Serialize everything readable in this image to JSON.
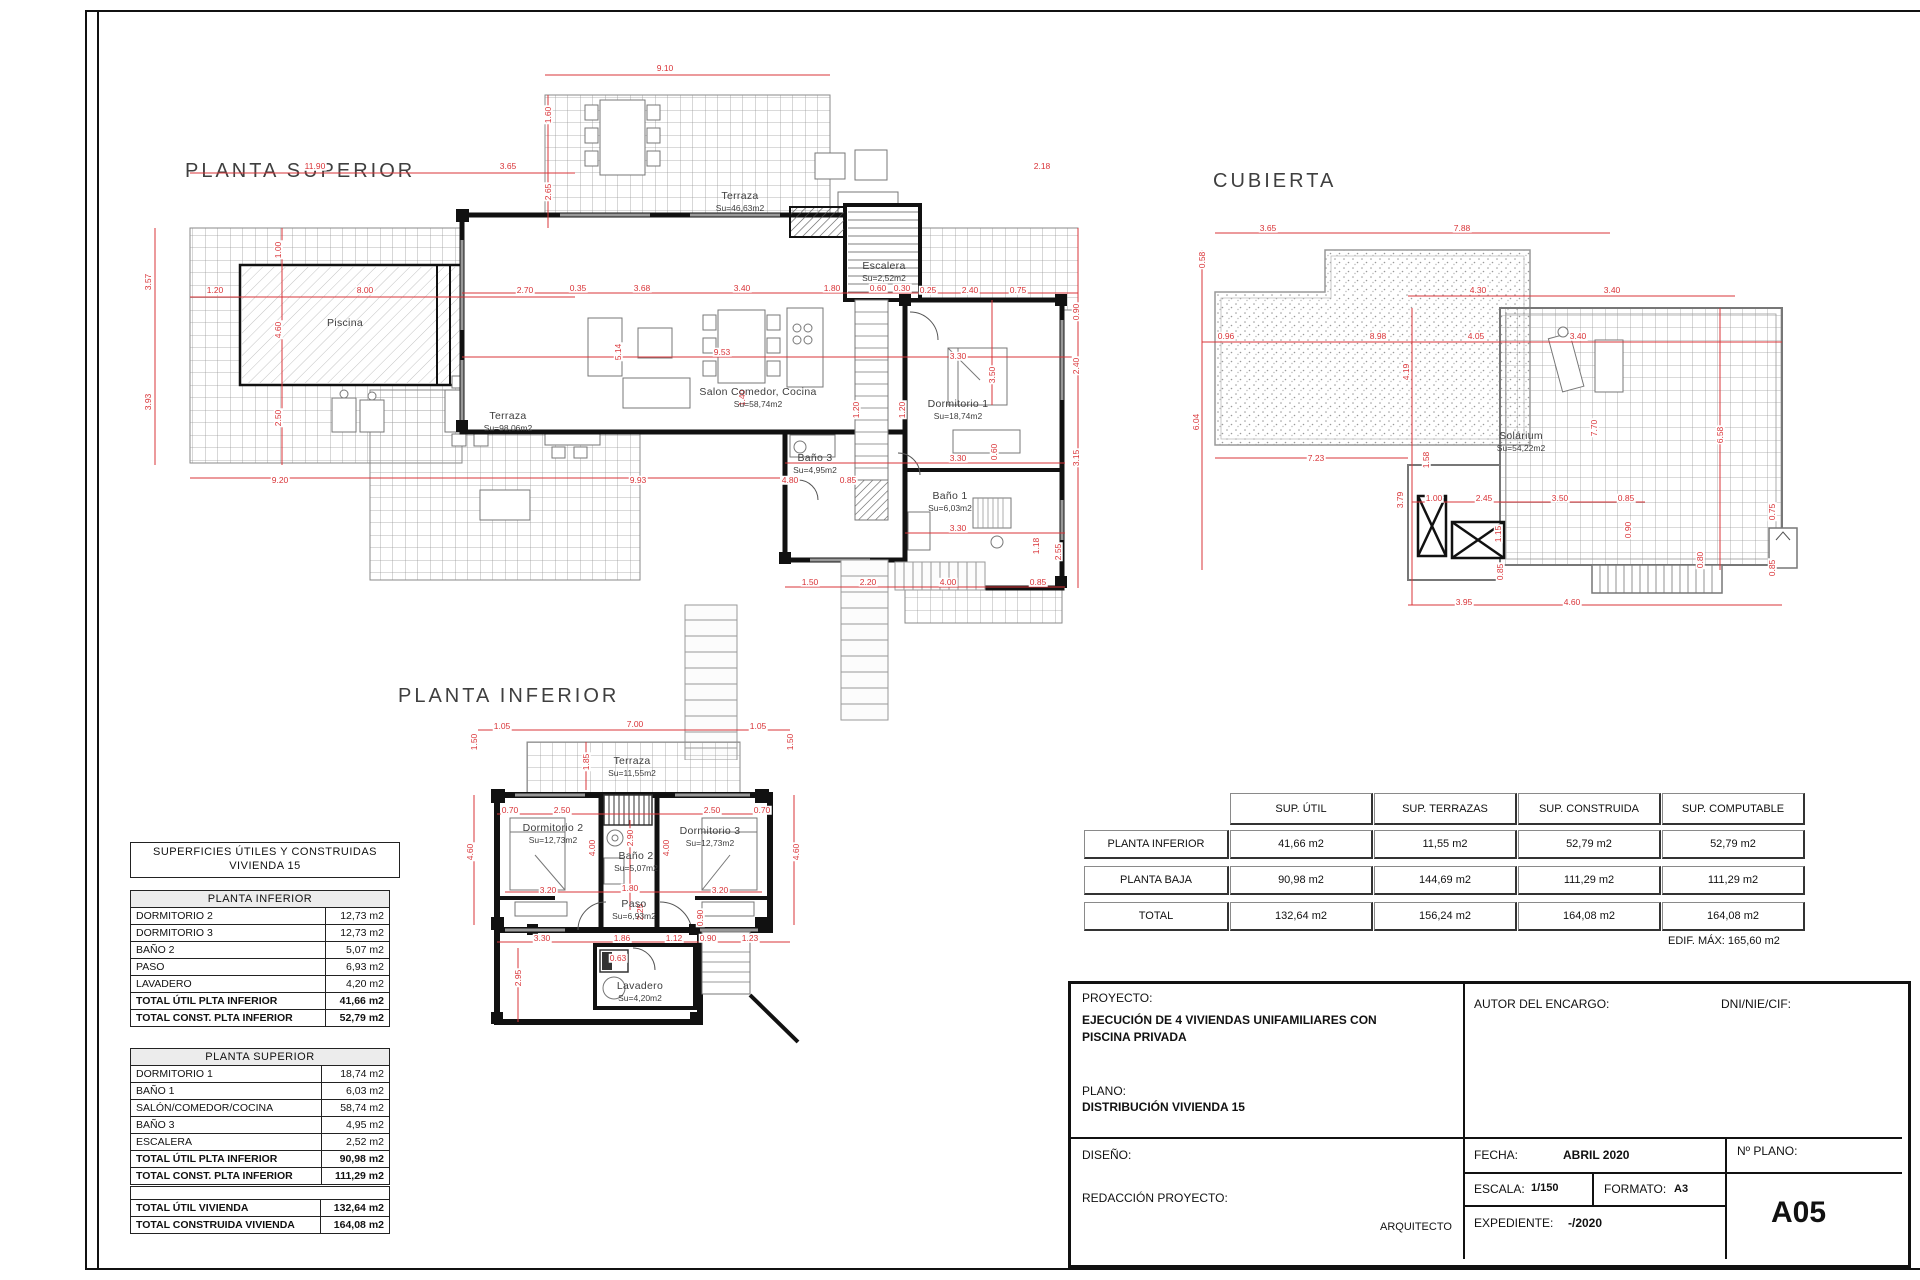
{
  "colors": {
    "dim_red": "#d93438",
    "wall": "#111111",
    "grid": "#9b9b9b",
    "accent_bg": "#ececec"
  },
  "plans": [
    {
      "id": "superior",
      "title": "PLANTA SUPERIOR",
      "rooms": [
        {
          "n": "Piscina",
          "a": "",
          "x": 215,
          "y": 262
        },
        {
          "n": "Terraza",
          "a": "Su=46,63m2",
          "x": 610,
          "y": 140
        },
        {
          "n": "Escalera",
          "a": "Su=2,52m2",
          "x": 754,
          "y": 210
        },
        {
          "n": "Salon  Comedor,  Cocina",
          "a": "Su=58,74m2",
          "x": 628,
          "y": 336
        },
        {
          "n": "Dormitorio  1",
          "a": "Su=18,74m2",
          "x": 828,
          "y": 348
        },
        {
          "n": "Terraza",
          "a": "Su=98,06m2",
          "x": 378,
          "y": 360
        },
        {
          "n": "Baño  3",
          "a": "Su=4,95m2",
          "x": 685,
          "y": 402
        },
        {
          "n": "Baño  1",
          "a": "Su=6,03m2",
          "x": 820,
          "y": 440
        }
      ],
      "dims": [
        {
          "t": "9.10",
          "x": 535,
          "y": 8
        },
        {
          "t": "11.90",
          "x": 185,
          "y": 106
        },
        {
          "t": "3.65",
          "x": 378,
          "y": 106
        },
        {
          "t": "2.18",
          "x": 912,
          "y": 106
        },
        {
          "t": "1.60",
          "x": 418,
          "y": 55,
          "v": 1
        },
        {
          "t": "2.65",
          "x": 418,
          "y": 132,
          "v": 1
        },
        {
          "t": "3.57",
          "x": 18,
          "y": 222,
          "v": 1
        },
        {
          "t": "3.93",
          "x": 18,
          "y": 342,
          "v": 1
        },
        {
          "t": "1.20",
          "x": 85,
          "y": 230
        },
        {
          "t": "8.00",
          "x": 235,
          "y": 230
        },
        {
          "t": "2.70",
          "x": 395,
          "y": 230
        },
        {
          "t": "1.00",
          "x": 148,
          "y": 190,
          "v": 1
        },
        {
          "t": "4.60",
          "x": 148,
          "y": 270,
          "v": 1
        },
        {
          "t": "2.50",
          "x": 148,
          "y": 358,
          "v": 1
        },
        {
          "t": "0.35",
          "x": 448,
          "y": 228
        },
        {
          "t": "3.68",
          "x": 512,
          "y": 228
        },
        {
          "t": "3.40",
          "x": 612,
          "y": 228
        },
        {
          "t": "1.80",
          "x": 702,
          "y": 228
        },
        {
          "t": "0.60",
          "x": 748,
          "y": 228
        },
        {
          "t": "0.30",
          "x": 772,
          "y": 228
        },
        {
          "t": "0.25",
          "x": 798,
          "y": 230
        },
        {
          "t": "2.40",
          "x": 840,
          "y": 230
        },
        {
          "t": "0.75",
          "x": 888,
          "y": 230
        },
        {
          "t": "5.14",
          "x": 488,
          "y": 292,
          "v": 1
        },
        {
          "t": "9.53",
          "x": 592,
          "y": 292
        },
        {
          "t": "1.40",
          "x": 612,
          "y": 338,
          "v": 1
        },
        {
          "t": "1.20",
          "x": 726,
          "y": 350,
          "v": 1
        },
        {
          "t": "1.20",
          "x": 772,
          "y": 350,
          "v": 1
        },
        {
          "t": "3.30",
          "x": 828,
          "y": 296
        },
        {
          "t": "3.50",
          "x": 862,
          "y": 315,
          "v": 1
        },
        {
          "t": "0.90",
          "x": 946,
          "y": 252,
          "v": 1
        },
        {
          "t": "2.40",
          "x": 946,
          "y": 306,
          "v": 1
        },
        {
          "t": "3.15",
          "x": 946,
          "y": 398,
          "v": 1
        },
        {
          "t": "3.30",
          "x": 828,
          "y": 398
        },
        {
          "t": "0.60",
          "x": 864,
          "y": 392,
          "v": 1
        },
        {
          "t": "3.30",
          "x": 828,
          "y": 468
        },
        {
          "t": "1.18",
          "x": 906,
          "y": 486,
          "v": 1
        },
        {
          "t": "2.55",
          "x": 928,
          "y": 492,
          "v": 1
        },
        {
          "t": "9.20",
          "x": 150,
          "y": 420
        },
        {
          "t": "9.93",
          "x": 508,
          "y": 420
        },
        {
          "t": "4.80",
          "x": 660,
          "y": 420
        },
        {
          "t": "0.85",
          "x": 718,
          "y": 420
        },
        {
          "t": "1.50",
          "x": 680,
          "y": 522
        },
        {
          "t": "2.20",
          "x": 738,
          "y": 522
        },
        {
          "t": "4.00",
          "x": 818,
          "y": 522
        },
        {
          "t": "0.85",
          "x": 908,
          "y": 522
        }
      ]
    },
    {
      "id": "cubierta",
      "title": "CUBIERTA",
      "rooms": [
        {
          "n": "Solárium",
          "a": "Su=54,22m2",
          "x": 341,
          "y": 300
        }
      ],
      "dims": [
        {
          "t": "3.65",
          "x": 88,
          "y": 88
        },
        {
          "t": "7.88",
          "x": 282,
          "y": 88
        },
        {
          "t": "0.58",
          "x": 22,
          "y": 120,
          "v": 1
        },
        {
          "t": "6.04",
          "x": 16,
          "y": 282,
          "v": 1
        },
        {
          "t": "0.96",
          "x": 46,
          "y": 196
        },
        {
          "t": "8.98",
          "x": 198,
          "y": 196
        },
        {
          "t": "4.05",
          "x": 296,
          "y": 196
        },
        {
          "t": "3.40",
          "x": 398,
          "y": 196
        },
        {
          "t": "4.30",
          "x": 298,
          "y": 150
        },
        {
          "t": "3.40",
          "x": 432,
          "y": 150
        },
        {
          "t": "4.19",
          "x": 226,
          "y": 232,
          "v": 1
        },
        {
          "t": "7.70",
          "x": 414,
          "y": 288,
          "v": 1
        },
        {
          "t": "6.58",
          "x": 540,
          "y": 295,
          "v": 1
        },
        {
          "t": "7.23",
          "x": 136,
          "y": 318
        },
        {
          "t": "1.58",
          "x": 246,
          "y": 320,
          "v": 1
        },
        {
          "t": "3.79",
          "x": 220,
          "y": 360,
          "v": 1
        },
        {
          "t": "1.00",
          "x": 254,
          "y": 358
        },
        {
          "t": "2.45",
          "x": 304,
          "y": 358
        },
        {
          "t": "3.50",
          "x": 380,
          "y": 358
        },
        {
          "t": "0.85",
          "x": 446,
          "y": 358
        },
        {
          "t": "1.15",
          "x": 318,
          "y": 394,
          "v": 1
        },
        {
          "t": "0.90",
          "x": 448,
          "y": 390,
          "v": 1
        },
        {
          "t": "0.75",
          "x": 592,
          "y": 372,
          "v": 1
        },
        {
          "t": "0.85",
          "x": 320,
          "y": 432,
          "v": 1
        },
        {
          "t": "0.80",
          "x": 520,
          "y": 420,
          "v": 1
        },
        {
          "t": "0.85",
          "x": 592,
          "y": 428,
          "v": 1
        },
        {
          "t": "3.95",
          "x": 284,
          "y": 462
        },
        {
          "t": "4.60",
          "x": 392,
          "y": 462
        }
      ]
    },
    {
      "id": "inferior",
      "title": "PLANTA INFERIOR",
      "rooms": [
        {
          "n": "Terraza",
          "a": "Su=11,55m2",
          "x": 242,
          "y": 85
        },
        {
          "n": "Dormitorio  2",
          "a": "Su=12,73m2",
          "x": 163,
          "y": 152
        },
        {
          "n": "Baño  2",
          "a": "Su=5,07m2",
          "x": 246,
          "y": 180
        },
        {
          "n": "Dormitorio  3",
          "a": "Su=12,73m2",
          "x": 320,
          "y": 155
        },
        {
          "n": "Paso",
          "a": "Su=6,93m2",
          "x": 244,
          "y": 228
        },
        {
          "n": "Lavadero",
          "a": "Su=4,20m2",
          "x": 250,
          "y": 310
        }
      ],
      "dims": [
        {
          "t": "1.05",
          "x": 112,
          "y": 46
        },
        {
          "t": "7.00",
          "x": 245,
          "y": 44
        },
        {
          "t": "1.05",
          "x": 368,
          "y": 46
        },
        {
          "t": "1.50",
          "x": 84,
          "y": 62,
          "v": 1
        },
        {
          "t": "1.50",
          "x": 400,
          "y": 62,
          "v": 1
        },
        {
          "t": "1.85",
          "x": 196,
          "y": 82,
          "v": 1
        },
        {
          "t": "0.70",
          "x": 120,
          "y": 130
        },
        {
          "t": "2.50",
          "x": 172,
          "y": 130
        },
        {
          "t": "2.50",
          "x": 322,
          "y": 130
        },
        {
          "t": "0.70",
          "x": 372,
          "y": 130
        },
        {
          "t": "4.60",
          "x": 80,
          "y": 172,
          "v": 1
        },
        {
          "t": "4.60",
          "x": 406,
          "y": 172,
          "v": 1
        },
        {
          "t": "4.00",
          "x": 202,
          "y": 168,
          "v": 1
        },
        {
          "t": "4.00",
          "x": 276,
          "y": 168,
          "v": 1
        },
        {
          "t": "2.90",
          "x": 240,
          "y": 158,
          "v": 1
        },
        {
          "t": "3.20",
          "x": 158,
          "y": 210
        },
        {
          "t": "1.80",
          "x": 240,
          "y": 208
        },
        {
          "t": "3.20",
          "x": 330,
          "y": 210
        },
        {
          "t": "2.25",
          "x": 250,
          "y": 232,
          "v": 1
        },
        {
          "t": "0.90",
          "x": 310,
          "y": 238,
          "v": 1
        },
        {
          "t": "3.30",
          "x": 152,
          "y": 258
        },
        {
          "t": "1.86",
          "x": 232,
          "y": 258
        },
        {
          "t": "1.12",
          "x": 284,
          "y": 258
        },
        {
          "t": "0.90",
          "x": 318,
          "y": 258
        },
        {
          "t": "1.23",
          "x": 360,
          "y": 258
        },
        {
          "t": "2.95",
          "x": 128,
          "y": 298,
          "v": 1
        },
        {
          "t": "0.63",
          "x": 228,
          "y": 278
        }
      ]
    }
  ],
  "left_tables": {
    "header1": "SUPERFICIES  ÚTILES  Y  CONSTRUIDAS",
    "header2": "VIVIENDA  15",
    "t1": {
      "title": "PLANTA  INFERIOR",
      "rows": [
        {
          "label": "DORMITORIO  2",
          "value": "12,73  m2"
        },
        {
          "label": "DORMITORIO  3",
          "value": "12,73  m2"
        },
        {
          "label": "BAÑO  2",
          "value": "5,07  m2"
        },
        {
          "label": "PASO",
          "value": "6,93  m2"
        },
        {
          "label": "LAVADERO",
          "value": "4,20  m2"
        },
        {
          "label": "TOTAL  ÚTIL  PLTA  INFERIOR",
          "value": "41,66  m2"
        },
        {
          "label": "TOTAL  CONST.  PLTA  INFERIOR",
          "value": "52,79  m2"
        }
      ]
    },
    "t2": {
      "title": "PLANTA  SUPERIOR",
      "rows": [
        {
          "label": "DORMITORIO  1",
          "value": "18,74  m2"
        },
        {
          "label": "BAÑO  1",
          "value": "6,03  m2"
        },
        {
          "label": "SALÓN/COMEDOR/COCINA",
          "value": "58,74  m2"
        },
        {
          "label": "BAÑO  3",
          "value": "4,95  m2"
        },
        {
          "label": "ESCALERA",
          "value": "2,52  m2"
        },
        {
          "label": "TOTAL  ÚTIL  PLTA  INFERIOR",
          "value": "90,98  m2"
        },
        {
          "label": "TOTAL  CONST.  PLTA  INFERIOR",
          "value": "111,29  m2"
        }
      ]
    },
    "totals": {
      "rows": [
        {
          "label": "TOTAL  ÚTIL  VIVIENDA",
          "value": "132,64  m2"
        },
        {
          "label": "TOTAL  CONSTRUIDA  VIVIENDA",
          "value": "164,08  m2"
        }
      ]
    }
  },
  "summary": {
    "headers": [
      "SUP. ÚTIL",
      "SUP. TERRAZAS",
      "SUP. CONSTRUIDA",
      "SUP. COMPUTABLE"
    ],
    "rows": [
      {
        "label": "PLANTA INFERIOR",
        "values": [
          "41,66 m2",
          "11,55 m2",
          "52,79 m2",
          "52,79 m2"
        ]
      },
      {
        "label": "PLANTA BAJA",
        "values": [
          "90,98 m2",
          "144,69 m2",
          "111,29 m2",
          "111,29 m2"
        ]
      },
      {
        "label": "TOTAL",
        "values": [
          "132,64 m2",
          "156,24 m2",
          "164,08 m2",
          "164,08 m2"
        ]
      }
    ],
    "note": "EDIF. MÁX: 165,60 m2"
  },
  "title_block": {
    "proyecto_label": "PROYECTO:",
    "proyecto_line1": "EJECUCIÓN DE 4 VIVIENDAS UNIFAMILIARES CON",
    "proyecto_line2": "PISCINA PRIVADA",
    "plano_label": "PLANO:",
    "plano_value": "DISTRIBUCIÓN VIVIENDA 15",
    "autor_label": "AUTOR DEL ENCARGO:",
    "dni_label": "DNI/NIE/CIF:",
    "diseno_label": "DISEÑO:",
    "redaccion_label": "REDACCIÓN PROYECTO:",
    "arquitecto_label": "ARQUITECTO",
    "fecha_label": "FECHA:",
    "fecha_value": "ABRIL 2020",
    "escala_label": "ESCALA:",
    "escala_value": "1/150",
    "formato_label": "FORMATO:",
    "formato_value": "A3",
    "expediente_label": "EXPEDIENTE:",
    "expediente_value": "-/2020",
    "num_plano_label": "Nº PLANO:",
    "num_plano_value": "A05"
  }
}
